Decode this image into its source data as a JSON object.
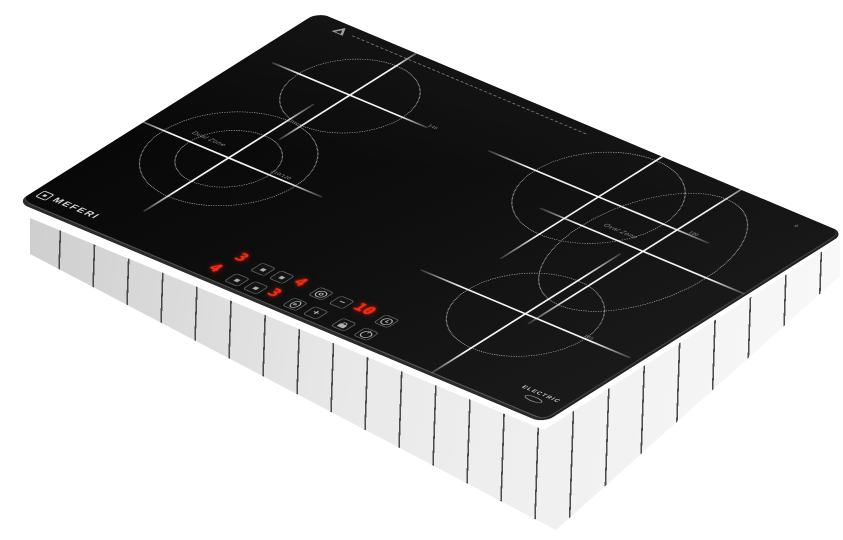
{
  "product": {
    "type": "built-in electric ceramic cooktop, 4 zones, angled product photo",
    "background_color": "#ffffff",
    "glass_color": "#0e0e0e",
    "base_color": "#e9e9e9",
    "led_color": "#ff2a12"
  },
  "branding": {
    "logo_text": "MEFERI",
    "electric_label": "ELECTRIC"
  },
  "markings": {
    "warning_icon": "hot-surface-warning-triangle",
    "corner_mark": "+"
  },
  "zones": [
    {
      "id": "back-left-zone",
      "label": "",
      "diameter_mark": "145"
    },
    {
      "id": "front-left-dual",
      "label": "Dual Zone",
      "diameter_mark": "210/120"
    },
    {
      "id": "back-right-zone",
      "label": "",
      "diameter_mark": "180"
    },
    {
      "id": "right-oval-zone",
      "label": "Oval Zone",
      "diameter_mark": ""
    },
    {
      "id": "front-center-zone",
      "label": "",
      "diameter_mark": "165"
    }
  ],
  "control_panel": {
    "displays": {
      "back_left": "3",
      "back_right": "4",
      "front_left": "4",
      "front_right": "3",
      "timer": "10"
    },
    "buttons": {
      "minus_label": "−",
      "plus_label": "+",
      "icons": [
        "zone-select",
        "dual-zone",
        "oval-zone",
        "timer-clock",
        "child-lock",
        "power"
      ]
    }
  }
}
